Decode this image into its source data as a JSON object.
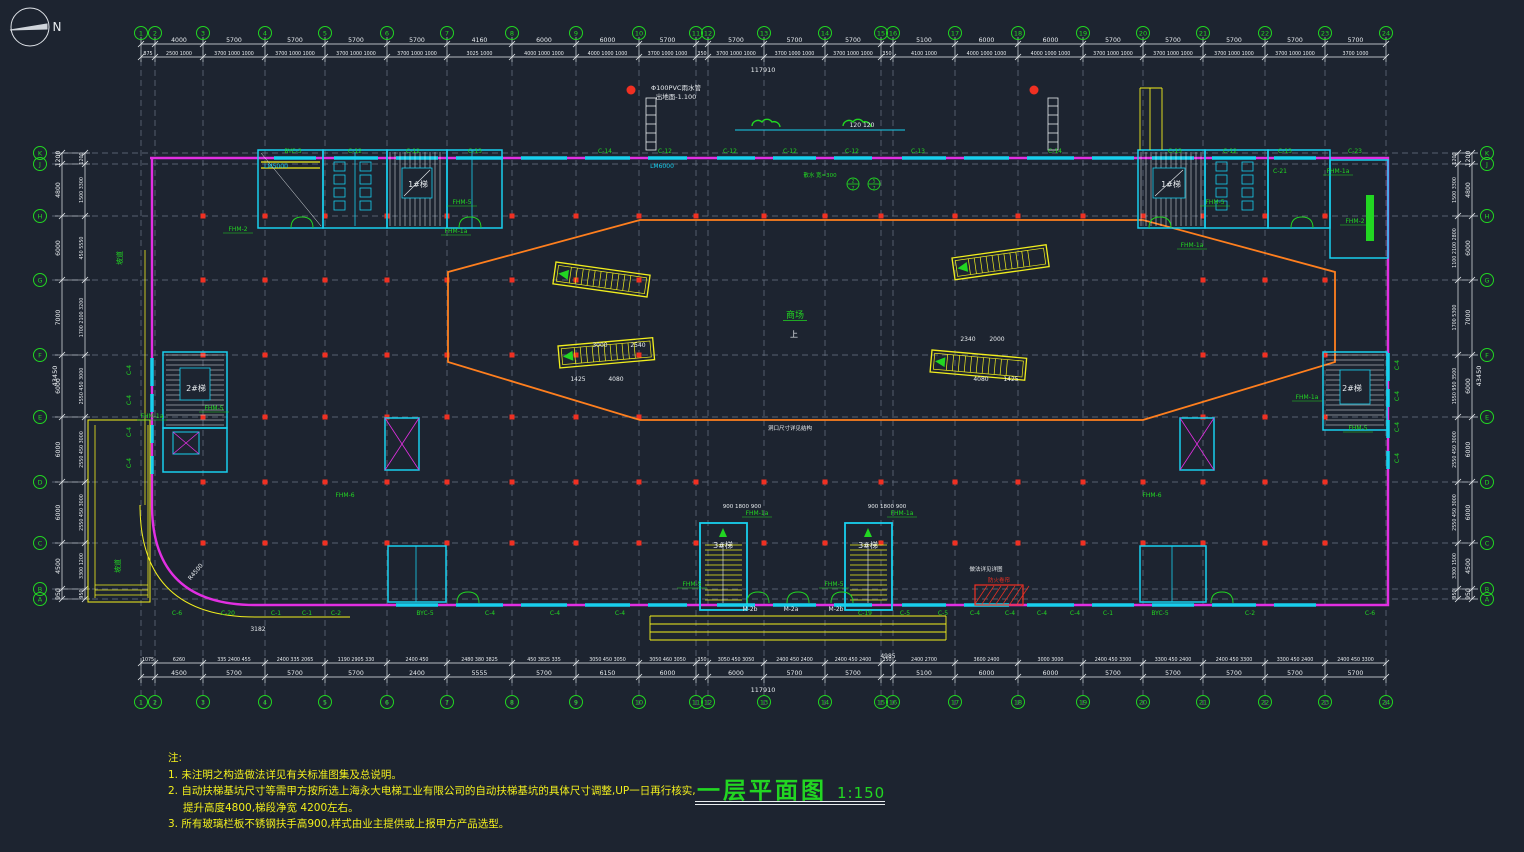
{
  "canvas": {
    "w": 1524,
    "h": 852,
    "bg": "#1d2430"
  },
  "colors": {
    "white": "#e8ecef",
    "green": "#22d622",
    "magenta": "#e22fe2",
    "cyan": "#18cfee",
    "yellow": "#f2ef1d",
    "orange": "#ff7f1e",
    "red": "#f03022",
    "grid": "#6b7685"
  },
  "north": {
    "label": "N"
  },
  "title": {
    "text": "一层平面图",
    "scale": "1:150"
  },
  "notes": {
    "header": "注:",
    "lines": [
      "1. 未注明之构造做法详见有关标准图集及总说明。",
      "2. 自动扶梯基坑尺寸等需甲方按所选上海永大电梯工业有限公司的自动扶梯基坑的具体尺寸调整,UP一日再行核实,",
      "提升高度4800,梯段净宽 4200左右。",
      "3. 所有玻璃栏板不锈钢扶手高900,样式由业主提供或上报甲方产品选型。"
    ]
  },
  "grid": {
    "cols": [
      {
        "l": "1",
        "x": 141,
        "d": 0
      },
      {
        "l": "2",
        "x": 155,
        "d": 0
      },
      {
        "l": "3",
        "x": 203,
        "d": 1
      },
      {
        "l": "4",
        "x": 265,
        "d": 1
      },
      {
        "l": "5",
        "x": 325,
        "d": 1
      },
      {
        "l": "6",
        "x": 387,
        "d": 1
      },
      {
        "l": "7",
        "x": 447,
        "d": 1
      },
      {
        "l": "8",
        "x": 512,
        "d": 1
      },
      {
        "l": "9",
        "x": 576,
        "d": 1
      },
      {
        "l": "10",
        "x": 639,
        "d": 1
      },
      {
        "l": "11",
        "x": 696,
        "d": 1
      },
      {
        "l": "12",
        "x": 708,
        "d": 0
      },
      {
        "l": "13",
        "x": 764,
        "d": 1
      },
      {
        "l": "14",
        "x": 825,
        "d": 1
      },
      {
        "l": "15",
        "x": 881,
        "d": 1
      },
      {
        "l": "16",
        "x": 893,
        "d": 0
      },
      {
        "l": "17",
        "x": 955,
        "d": 1
      },
      {
        "l": "18",
        "x": 1018,
        "d": 1
      },
      {
        "l": "19",
        "x": 1083,
        "d": 1
      },
      {
        "l": "20",
        "x": 1143,
        "d": 1
      },
      {
        "l": "21",
        "x": 1203,
        "d": 1
      },
      {
        "l": "22",
        "x": 1265,
        "d": 1
      },
      {
        "l": "23",
        "x": 1325,
        "d": 1
      },
      {
        "l": "24",
        "x": 1386,
        "d": 0
      }
    ],
    "rows": [
      {
        "l": "K",
        "y": 153,
        "d": 0
      },
      {
        "l": "J",
        "y": 164,
        "d": 0
      },
      {
        "l": "H",
        "y": 216,
        "d": 1
      },
      {
        "l": "G",
        "y": 280,
        "d": 1
      },
      {
        "l": "F",
        "y": 355,
        "d": 1
      },
      {
        "l": "E",
        "y": 417,
        "d": 1
      },
      {
        "l": "D",
        "y": 482,
        "d": 1
      },
      {
        "l": "C",
        "y": 543,
        "d": 1
      },
      {
        "l": "B",
        "y": 589,
        "d": 0
      },
      {
        "l": "A",
        "y": 599,
        "d": 0
      }
    ]
  },
  "dims": {
    "top1": [
      "",
      "4000",
      "5700",
      "5700",
      "5700",
      "5700",
      "4160",
      "6000",
      "6000",
      "5700",
      "",
      "5700",
      "5700",
      "5700",
      "",
      "5100",
      "6000",
      "6000",
      "5700",
      "5700",
      "5700",
      "5700",
      "5700"
    ],
    "top2": [
      "875",
      "2500 1000",
      "3700 1000 1000",
      "3700 1000 1000",
      "3700 1000 1000",
      "3700 1000 1000",
      "3025 1000",
      "4000 1000 1000",
      "4000 1000 1000",
      "3700 1000 1000",
      "350",
      "3700 1000 1000",
      "3700 1000 1000",
      "3700 1000 1000",
      "350",
      "4100 1000",
      "4000 1000 1000",
      "4000 1000 1000",
      "3700 1000 1000",
      "3700 1000 1000",
      "3700 1000 1000",
      "3700 1000 1000",
      "3700 1000"
    ],
    "bottom1": [
      "",
      "4500",
      "5700",
      "5700",
      "5700",
      "2400",
      "5555",
      "5700",
      "6150",
      "6000",
      "",
      "6000",
      "5700",
      "5700",
      "",
      "5100",
      "6000",
      "6000",
      "5700",
      "5700",
      "5700",
      "5700",
      "5700"
    ],
    "bottom2": [
      "1075",
      "6260",
      "335 2400 455",
      "2400 335 2065",
      "1190 2905 330",
      "2400 450",
      "2480 380 3825",
      "450 3825 335",
      "3050 450 3050",
      "3050 460 3050",
      "350",
      "3050 450 3050",
      "2400 450 2400",
      "2400 450 2400",
      "350",
      "2400 2700",
      "3600 2400",
      "3000 3000",
      "2400 450 3300",
      "3300 450 2400",
      "2400 450 3300",
      "3300 450 2400",
      "2400 450 3300"
    ],
    "left1": [
      "1200",
      "4800",
      "6000",
      "7000",
      "6000",
      "6000",
      "6000",
      "4500",
      "950"
    ],
    "left2": [
      "1200",
      "1500 3300",
      "450 5550",
      "1700 2100 3200",
      "2550 450 3000",
      "2550 450 3000",
      "2550 450 3000",
      "3300 1200",
      "950"
    ],
    "right1": [
      "1200",
      "4800",
      "6000",
      "7000",
      "6000",
      "6000",
      "6000",
      "4500",
      "950"
    ],
    "right2": [
      "1200",
      "1500 3300",
      "1100 2100 2800",
      "1700 5300",
      "1550 950 3500",
      "2550 450 3000",
      "2550 450 3000",
      "3300 1500",
      "950"
    ],
    "overall": {
      "top": "117910",
      "bottom": "117910",
      "left": "43450",
      "right": "43450"
    }
  },
  "labels": {
    "top_windows": [
      {
        "x": 293,
        "t": "BYC-3"
      },
      {
        "x": 355,
        "t": "C-12"
      },
      {
        "x": 413,
        "t": "C-12"
      },
      {
        "x": 475,
        "t": "C-13"
      },
      {
        "x": 605,
        "t": "C-14"
      },
      {
        "x": 665,
        "t": "C-12"
      },
      {
        "x": 730,
        "t": "C-12"
      },
      {
        "x": 790,
        "t": "C-12"
      },
      {
        "x": 852,
        "t": "C-12"
      },
      {
        "x": 918,
        "t": "C-13"
      },
      {
        "x": 1055,
        "t": "C-14"
      },
      {
        "x": 1175,
        "t": "C-13"
      },
      {
        "x": 1230,
        "t": "C-12"
      },
      {
        "x": 1285,
        "t": "C-13"
      },
      {
        "x": 1355,
        "t": "C-23"
      }
    ],
    "bottom_windows": [
      {
        "x": 177,
        "t": "C-6"
      },
      {
        "x": 228,
        "t": "C-20"
      },
      {
        "x": 276,
        "t": "C-1"
      },
      {
        "x": 307,
        "t": "C-1"
      },
      {
        "x": 336,
        "t": "C-2"
      },
      {
        "x": 425,
        "t": "BYC-5"
      },
      {
        "x": 490,
        "t": "C-4"
      },
      {
        "x": 555,
        "t": "C-4"
      },
      {
        "x": 620,
        "t": "C-4"
      },
      {
        "x": 865,
        "t": "C-19"
      },
      {
        "x": 905,
        "t": "C-5"
      },
      {
        "x": 943,
        "t": "C-5"
      },
      {
        "x": 975,
        "t": "C-4"
      },
      {
        "x": 1010,
        "t": "C-4"
      },
      {
        "x": 1042,
        "t": "C-4"
      },
      {
        "x": 1075,
        "t": "C-4"
      },
      {
        "x": 1108,
        "t": "C-1"
      },
      {
        "x": 1160,
        "t": "BYC-5"
      },
      {
        "x": 1250,
        "t": "C-2"
      },
      {
        "x": 1370,
        "t": "C-6"
      }
    ],
    "left_windows": [
      {
        "y": 370,
        "t": "C-4"
      },
      {
        "y": 400,
        "t": "C-4"
      },
      {
        "y": 432,
        "t": "C-4"
      },
      {
        "y": 463,
        "t": "C-4"
      }
    ],
    "right_windows": [
      {
        "y": 365,
        "t": "C-4"
      },
      {
        "y": 396,
        "t": "C-4"
      },
      {
        "y": 427,
        "t": "C-4"
      },
      {
        "y": 458,
        "t": "C-4"
      }
    ],
    "stairs": [
      {
        "x": 418,
        "y": 187,
        "t": "1#梯"
      },
      {
        "x": 1171,
        "y": 187,
        "t": "1#梯"
      },
      {
        "x": 196,
        "y": 391,
        "t": "2#梯"
      },
      {
        "x": 1352,
        "y": 391,
        "t": "2#梯"
      },
      {
        "x": 723,
        "y": 548,
        "t": "3#梯"
      },
      {
        "x": 868,
        "y": 548,
        "t": "3#梯"
      }
    ],
    "doors": [
      {
        "x": 238,
        "y": 231,
        "t": "FHM-2"
      },
      {
        "x": 462,
        "y": 204,
        "t": "FHM-5"
      },
      {
        "x": 456,
        "y": 233,
        "t": "FHM-1a"
      },
      {
        "x": 1215,
        "y": 204,
        "t": "FHM-5"
      },
      {
        "x": 1192,
        "y": 247,
        "t": "FHM-1a"
      },
      {
        "x": 1355,
        "y": 223,
        "t": "FHM-2"
      },
      {
        "x": 1338,
        "y": 173,
        "t": "FHM-1a"
      },
      {
        "x": 214,
        "y": 410,
        "t": "FHM-5"
      },
      {
        "x": 152,
        "y": 418,
        "t": "FHM-1a"
      },
      {
        "x": 1358,
        "y": 430,
        "t": "FHM-5"
      },
      {
        "x": 1307,
        "y": 399,
        "t": "FHM-1a"
      },
      {
        "x": 757,
        "y": 515,
        "t": "FHM-1a"
      },
      {
        "x": 902,
        "y": 515,
        "t": "FHM-1a"
      },
      {
        "x": 692,
        "y": 586,
        "t": "FHM-5"
      },
      {
        "x": 834,
        "y": 586,
        "t": "FHM-5"
      }
    ],
    "misc": [
      {
        "x": 676,
        "y": 90,
        "t": "Φ100PVC雨水管",
        "c": "white",
        "s": 6.5
      },
      {
        "x": 676,
        "y": 99,
        "t": "出地面-1.100",
        "c": "white",
        "s": 6.5
      },
      {
        "x": 862,
        "y": 127,
        "t": "120  120",
        "c": "white",
        "s": 6
      },
      {
        "x": 276,
        "y": 168,
        "t": "LM5000",
        "c": "cyan",
        "s": 6
      },
      {
        "x": 662,
        "y": 168,
        "t": "LM6000",
        "c": "cyan",
        "s": 6
      },
      {
        "x": 820,
        "y": 177,
        "t": "散水 宽=300",
        "c": "green",
        "s": 5.5
      },
      {
        "x": 795,
        "y": 318,
        "t": "商场",
        "c": "green",
        "s": 9,
        "u": 1
      },
      {
        "x": 794,
        "y": 337,
        "t": "上",
        "c": "white",
        "s": 8
      },
      {
        "x": 986,
        "y": 571,
        "t": "做法详见详图",
        "c": "white",
        "s": 5.5
      },
      {
        "x": 999,
        "y": 582,
        "t": "防火卷帘",
        "c": "red",
        "s": 5.5
      },
      {
        "x": 122,
        "y": 258,
        "t": "坡道",
        "c": "green",
        "s": 7,
        "r": -90
      },
      {
        "x": 120,
        "y": 566,
        "t": "坡道",
        "c": "green",
        "s": 7,
        "r": -90
      },
      {
        "x": 258,
        "y": 631,
        "t": "3182",
        "c": "white",
        "s": 6
      },
      {
        "x": 197,
        "y": 573,
        "t": "R4500",
        "c": "white",
        "s": 6,
        "r": -50
      },
      {
        "x": 600,
        "y": 347,
        "t": "3000",
        "c": "white",
        "s": 6
      },
      {
        "x": 638,
        "y": 347,
        "t": "2540",
        "c": "white",
        "s": 6
      },
      {
        "x": 578,
        "y": 381,
        "t": "1425",
        "c": "white",
        "s": 6
      },
      {
        "x": 616,
        "y": 381,
        "t": "4080",
        "c": "white",
        "s": 6
      },
      {
        "x": 968,
        "y": 341,
        "t": "2340",
        "c": "white",
        "s": 6
      },
      {
        "x": 997,
        "y": 341,
        "t": "2000",
        "c": "white",
        "s": 6
      },
      {
        "x": 981,
        "y": 381,
        "t": "4080",
        "c": "white",
        "s": 6
      },
      {
        "x": 1011,
        "y": 381,
        "t": "1425",
        "c": "white",
        "s": 6
      },
      {
        "x": 1280,
        "y": 173,
        "t": "C-21",
        "c": "green",
        "s": 6
      },
      {
        "x": 888,
        "y": 658,
        "t": "4985",
        "c": "white",
        "s": 6
      },
      {
        "x": 790,
        "y": 430,
        "t": "洞口尺寸详见结构",
        "c": "white",
        "s": 5.5
      },
      {
        "x": 345,
        "y": 497,
        "t": "FHM-6",
        "c": "green",
        "s": 6
      },
      {
        "x": 1152,
        "y": 497,
        "t": "FHM-6",
        "c": "green",
        "s": 6
      },
      {
        "x": 742,
        "y": 508,
        "t": "900 1800 900",
        "c": "white",
        "s": 5.5
      },
      {
        "x": 887,
        "y": 508,
        "t": "900 1800 900",
        "c": "white",
        "s": 5.5
      },
      {
        "x": 750,
        "y": 611,
        "t": "M-2b",
        "c": "white",
        "s": 6
      },
      {
        "x": 791,
        "y": 611,
        "t": "M-2a",
        "c": "white",
        "s": 6
      },
      {
        "x": 836,
        "y": 611,
        "t": "M-2b",
        "c": "white",
        "s": 6
      }
    ],
    "callouts": [
      {
        "x": 853,
        "y": 184,
        "a": "2",
        "b": "7"
      },
      {
        "x": 874,
        "y": 184,
        "a": "5",
        "b": "7"
      }
    ]
  }
}
